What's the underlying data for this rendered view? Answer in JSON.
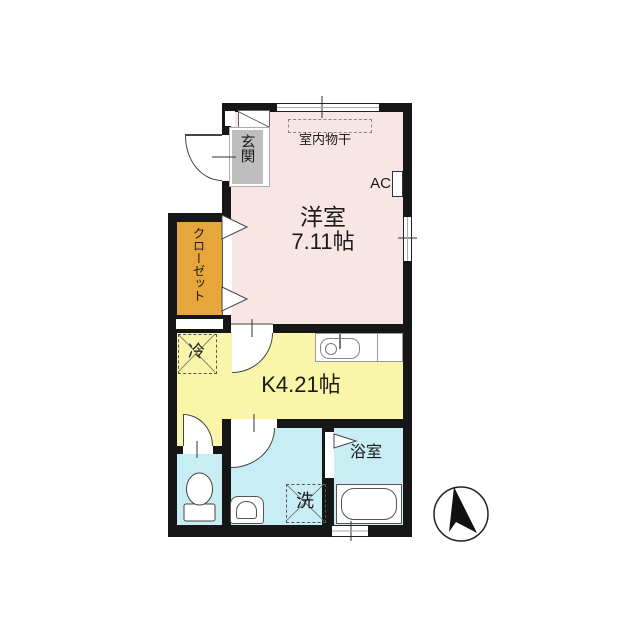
{
  "rooms": {
    "living": {
      "name": "洋室",
      "size": "7.11帖",
      "color": "#F7E6E3"
    },
    "kitchen": {
      "name": "K4.21帖",
      "color": "#FAF6A9"
    },
    "closet": {
      "name": "クローゼット",
      "color": "#E6A63C"
    },
    "entrance": {
      "name": "玄関",
      "mat_color": "#BEBEBE"
    },
    "bathroom": {
      "name": "浴室",
      "color": "#C8EDF4"
    },
    "washroom": {
      "color": "#C8EDF4"
    },
    "toilet": {
      "color": "#C8EDF4"
    }
  },
  "fixtures": {
    "indoor_drying": "室内物干",
    "air_conditioner": "AC",
    "refrigerator": "冷",
    "washing_machine": "洗"
  },
  "icons": {
    "north_arrow": "compass-north-arrow",
    "toilet": "toilet-icon",
    "bathtub": "bathtub-icon",
    "sink": "kitchen-sink-icon",
    "washbasin": "washbasin-icon"
  },
  "colors": {
    "wall": "#161616",
    "living": "#F7E6E3",
    "kitchen": "#FAF6A9",
    "closet": "#E6A63C",
    "wet_rooms": "#C8EDF4",
    "entrance_mat": "#BEBEBE",
    "line": "#444444"
  }
}
